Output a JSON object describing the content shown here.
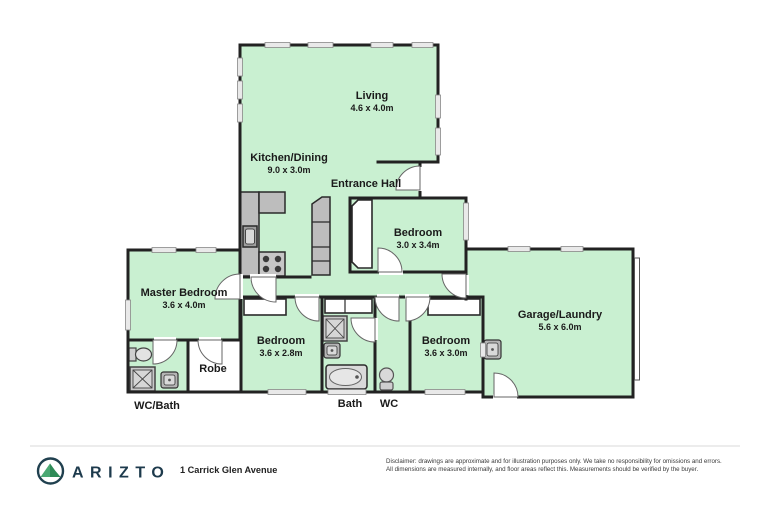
{
  "plan": {
    "type": "residential-floor-plan",
    "rooms": {
      "living": {
        "name": "Living",
        "dims": "4.6 x 4.0m"
      },
      "kitchen_dining": {
        "name": "Kitchen/Dining",
        "dims": "9.0 x 3.0m"
      },
      "entrance_hall": {
        "name": "Entrance Hall"
      },
      "bedroom_top": {
        "name": "Bedroom",
        "dims": "3.0 x 3.4m"
      },
      "master_bedroom": {
        "name": "Master Bedroom",
        "dims": "3.6 x 4.0m"
      },
      "bedroom_mid": {
        "name": "Bedroom",
        "dims": "3.6 x 2.8m"
      },
      "robe": {
        "name": "Robe"
      },
      "wc_bath": {
        "name": "WC/Bath"
      },
      "bath": {
        "name": "Bath"
      },
      "wc": {
        "name": "WC"
      },
      "bedroom_right": {
        "name": "Bedroom",
        "dims": "3.6 x 3.0m"
      },
      "garage_laundry": {
        "name": "Garage/Laundry",
        "dims": "5.6 x 6.0m"
      }
    },
    "fixtures": [
      "kitchen-counter",
      "kitchen-sink",
      "stove",
      "pantry-column",
      "wardrobe",
      "linen-cupboard",
      "shower",
      "bathtub",
      "toilet",
      "hand-basin",
      "laundry-tub",
      "garage-door"
    ],
    "colors": {
      "room_fill": "#c9f0d1",
      "wall": "#222222",
      "fixture_gray": "#bdbdbd",
      "window_fill": "#e9e9e9"
    }
  },
  "footer": {
    "brand": "ARIZTO",
    "logo": "mountain-in-circle",
    "address": "1 Carrick Glen Avenue",
    "disclaimer_line1": "Disclaimer: drawings are approximate and for illustration purposes only. We take no responsibility for omissions and errors.",
    "disclaimer_line2": "All dimensions are measured internally, and floor areas reflect this. Measurements should be verified by the buyer.",
    "colors": {
      "brand_navy": "#1d3a4c",
      "brand_green": "#3f9e68"
    }
  }
}
